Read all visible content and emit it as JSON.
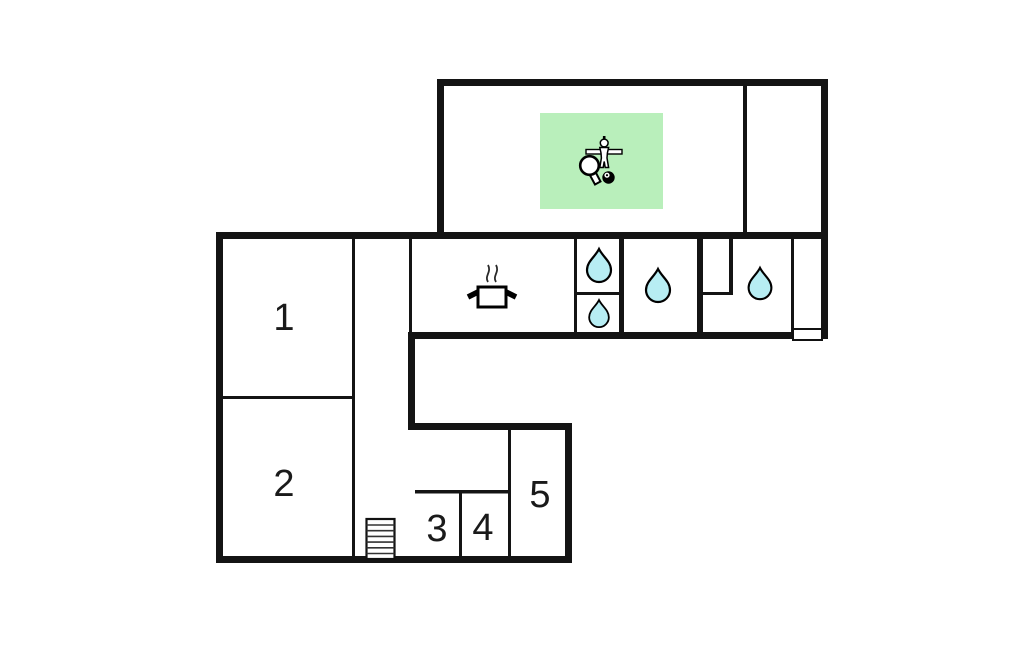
{
  "floorplan": {
    "kind": "holiday-home-floor-plan",
    "rooms": [
      {
        "label": "1"
      },
      {
        "label": "2"
      },
      {
        "label": "3"
      },
      {
        "label": "4"
      },
      {
        "label": "5"
      }
    ],
    "features": {
      "game_area_icons": [
        "table-tennis-paddle",
        "foosball-player",
        "billiard-ball"
      ],
      "kitchen_icon": "cooking-pot-with-steam",
      "bathroom_icon": "water-drop",
      "water_drop_count": 4,
      "stairs_icon": "stairs",
      "entrance_icon": "door"
    },
    "colors": {
      "wall": "#141414",
      "background": "#ffffff",
      "game_area": "#b9efbb",
      "water_drop": "#b7edf3",
      "door_fill": "#ffffff",
      "icon_fill": "#ffffff",
      "icon_outline": "#000000"
    }
  }
}
